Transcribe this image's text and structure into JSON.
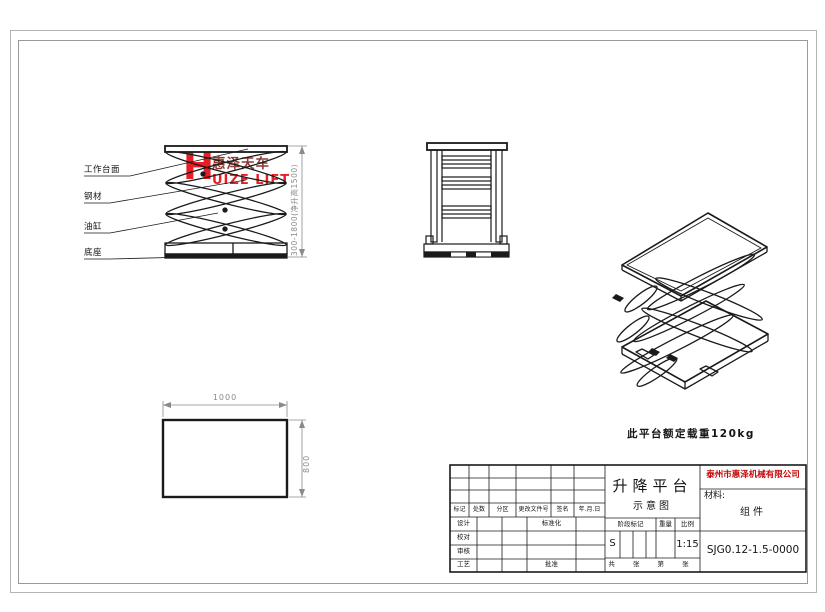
{
  "sheet": {
    "type": "engineering-drawing",
    "line_color": "#1a1a1a",
    "dim_color": "#8a8a8a",
    "accent_red": "#ec1c24",
    "dark_red": "#8e3b35"
  },
  "logo": {
    "h": "H",
    "cn": "惠泽天车",
    "en": "UIZE LIFT"
  },
  "front_view": {
    "labels": [
      "工作台面",
      "钢材",
      "油缸",
      "底座"
    ],
    "dim_height": "300-1800(净升高1500)"
  },
  "top_view": {
    "dim_width": "1000",
    "dim_depth": "800"
  },
  "note": "此平台额定载重120kg",
  "title_block": {
    "company": "泰州市惠泽机械有限公司",
    "title": "升降平台",
    "subtitle": "示意图",
    "material_label": "材料:",
    "material_value": "组件",
    "drawing_no": "SJG0.12-1.5-0000",
    "stage_mark": "S",
    "scale_value": "1:15",
    "rev_headers": [
      "标记",
      "处数",
      "分区",
      "更改文件号",
      "签名",
      "年.月.日"
    ],
    "sign_rows": [
      "设计",
      "校对",
      "审核",
      "工艺"
    ],
    "std_label": "标准化",
    "approve_label": "批准",
    "stage_label": "阶段标记",
    "weight_label": "重量",
    "scale_label": "比例",
    "sheet_row": "共 张 第 张"
  }
}
